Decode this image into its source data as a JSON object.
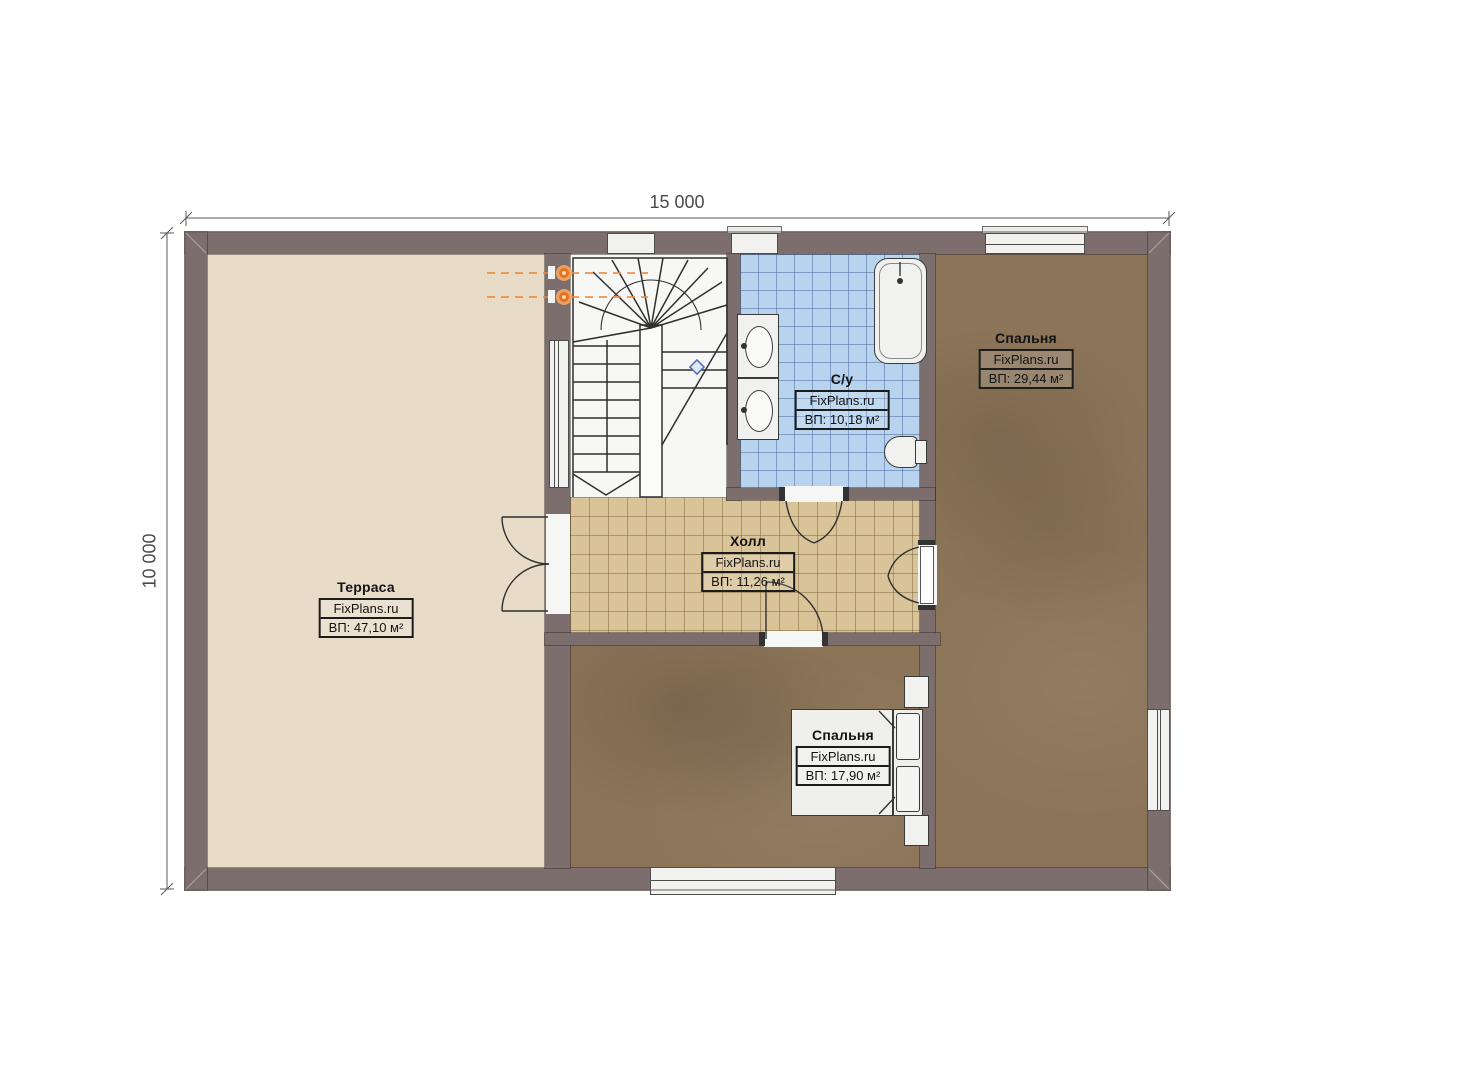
{
  "dimensions": {
    "width_label": "15 000",
    "height_label": "10 000"
  },
  "rooms": [
    {
      "name": "Терраса",
      "brand": "FixPlans.ru",
      "area": "ВП: 47,10 м²"
    },
    {
      "name": "Спальня",
      "brand": "FixPlans.ru",
      "area": "ВП: 29,44 м²"
    },
    {
      "name": "С/у",
      "brand": "FixPlans.ru",
      "area": "ВП: 10,18 м²"
    },
    {
      "name": "Холл",
      "brand": "FixPlans.ru",
      "area": "ВП: 11,26 м²"
    },
    {
      "name": "Спальня",
      "brand": "FixPlans.ru",
      "area": "ВП: 17,90 м²"
    }
  ],
  "symbols": {
    "staircase": "u-shaped-winder-stairs",
    "lights": "wall-light-icon",
    "doors": "door-swing-arc",
    "bath": "bathtub-icon",
    "sinks": "double-sink-icon",
    "toilet": "toilet-icon",
    "bed": "double-bed-icon"
  },
  "colors": {
    "wall": "#7d6e6e",
    "terrace_floor": "#e8dcc8",
    "hall_floor": "#d9c399",
    "bath_floor": "#b7d3ee",
    "bedroom_floor": "#8b7458",
    "fixture": "#f1f1ef",
    "accent_light": "#e8711f",
    "dimension": "#4a4a4a"
  }
}
